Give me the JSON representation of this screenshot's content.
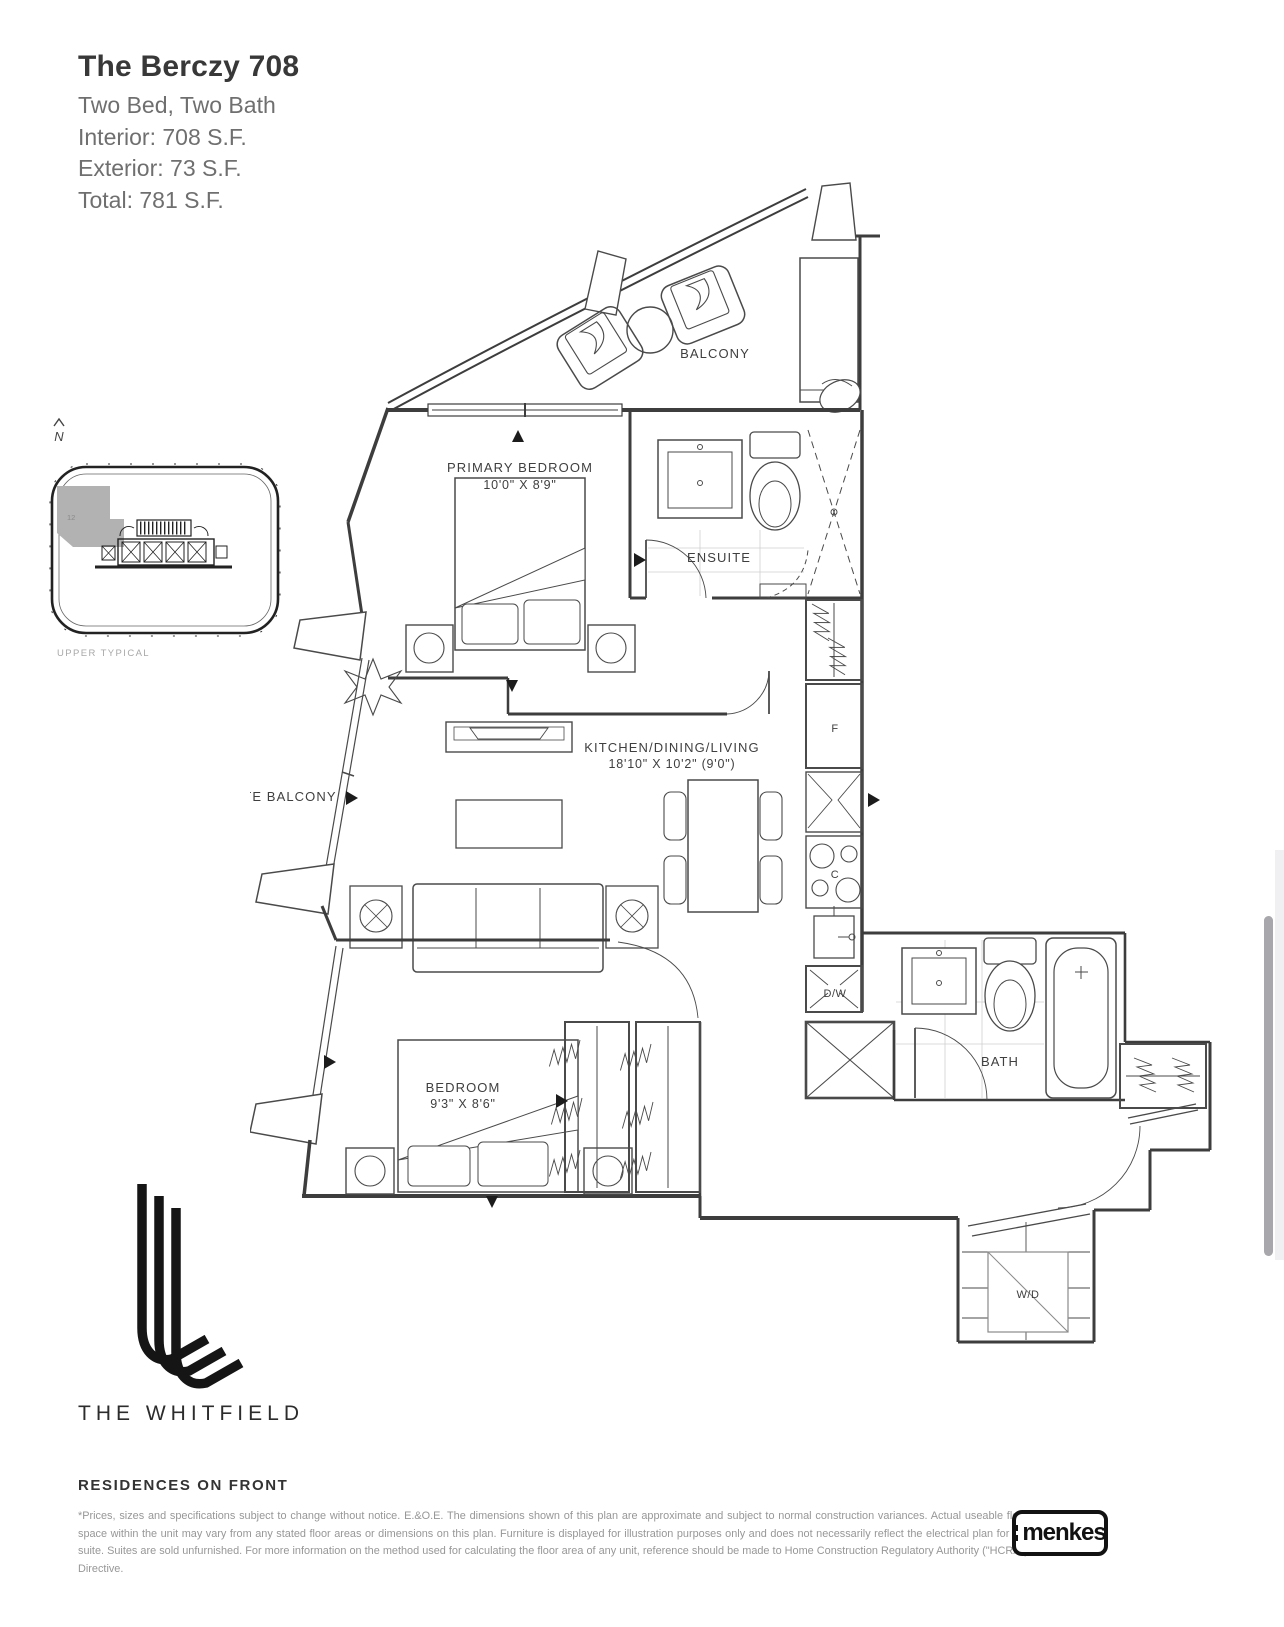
{
  "header": {
    "title": "The Berczy 708",
    "subtitle": "Two Bed, Two Bath",
    "interior": "Interior: 708 S.F.",
    "exterior": "Exterior: 73 S.F.",
    "total": "Total: 781 S.F."
  },
  "key_plan": {
    "north_label": "N",
    "unit_marker": "12",
    "caption": "UPPER TYPICAL"
  },
  "floor_plan": {
    "rooms": {
      "balcony": "BALCONY",
      "primary_bedroom": "PRIMARY BEDROOM",
      "primary_bedroom_dims": "10'0\" X 8'9\"",
      "ensuite": "ENSUITE",
      "kitchen": "KITCHEN/DINING/LIVING",
      "kitchen_dims": "18'10\" X 10'2\" (9'0\")",
      "juliette_balcony": "JULIETTE BALCONY",
      "bedroom": "BEDROOM",
      "bedroom_dims": "9'3\" X 8'6\"",
      "bath": "BATH"
    },
    "appliances": {
      "fridge": "F",
      "cooktop": "C",
      "dishwasher": "D/W",
      "washer_dryer": "W/D"
    }
  },
  "footer": {
    "brand": "THE WHITFIELD",
    "tagline": "RESIDENCES ON FRONT",
    "disclaimer": "*Prices, sizes and specifications subject to change without notice. E.&O.E. The dimensions shown of this plan are approximate and subject to normal construction variances. Actual useable floor space within the unit may vary from any stated floor areas or dimensions on this plan. Furniture is displayed for illustration purposes only and does not necessarily reflect the electrical plan for the suite. Suites are sold unfurnished. For more information on the method used for calculating the floor area of any unit, reference should be made to Home Construction Regulatory Authority (\"HCRA\") Directive.",
    "developer_logo": "menkes"
  },
  "colors": {
    "line": "#3d3d3d",
    "muted": "#979797",
    "highlight": "#b5b5b5"
  }
}
